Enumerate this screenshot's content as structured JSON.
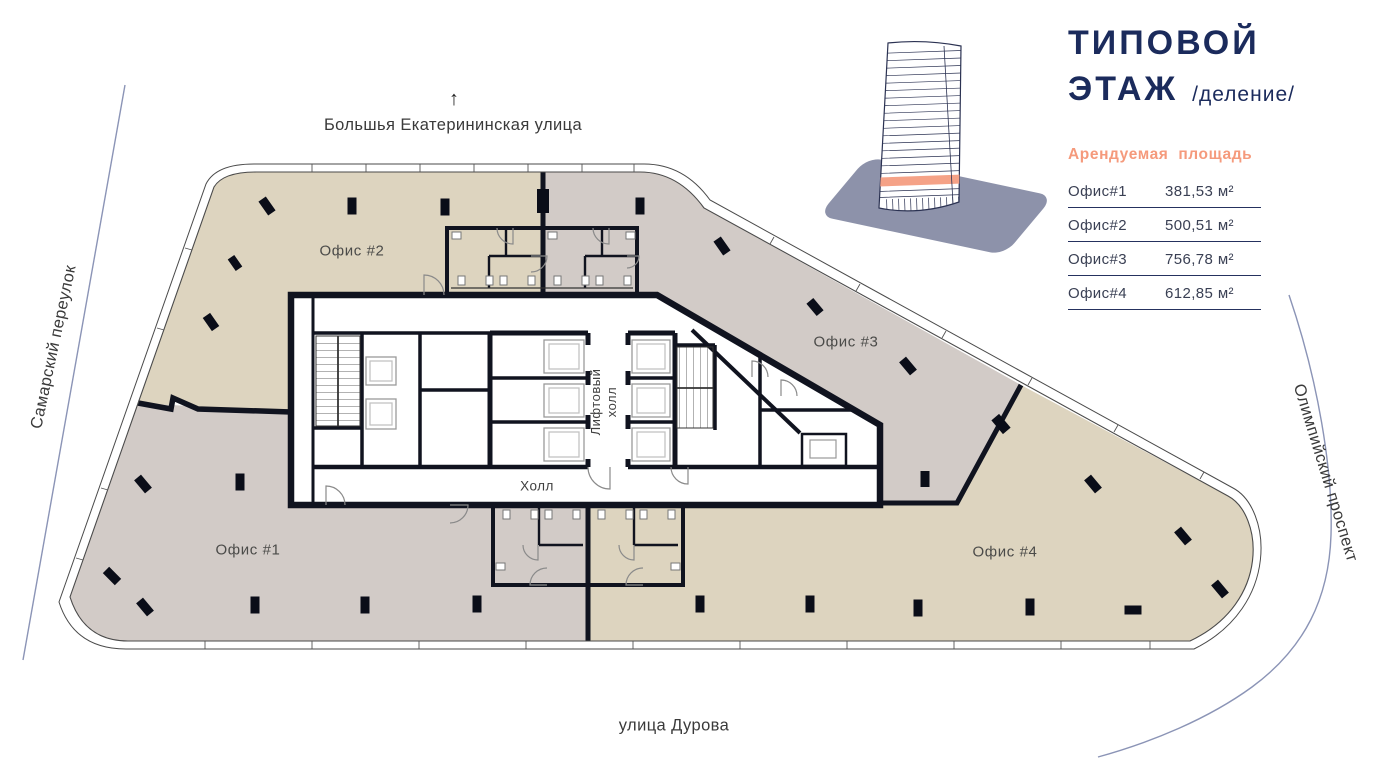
{
  "header": {
    "title_line1": "ТИПОВОЙ",
    "title_line2": "ЭТАЖ",
    "title_suffix": "/деление/",
    "building_icon": "tower-wireframe-highlighted-floor-icon"
  },
  "legend": {
    "title": "Арендуемая площадь",
    "rows": [
      {
        "name": "Офис#1",
        "area": "381,53 м²"
      },
      {
        "name": "Офис#2",
        "area": "500,51 м²"
      },
      {
        "name": "Офис#3",
        "area": "756,78 м²"
      },
      {
        "name": "Офис#4",
        "area": "612,85 м²"
      }
    ]
  },
  "streets": {
    "top_arrow": "↑",
    "top": "Большья Екатерининская улица",
    "left": "Самарский переулок",
    "right": "Олимпийский проспект",
    "bottom": "улица Дурова"
  },
  "plan": {
    "office1": "Офис #1",
    "office2": "Офис #2",
    "office3": "Офис #3",
    "office4": "Офис #4",
    "hall": "Холл",
    "lift_hall": "Лифтовый холл"
  },
  "colors": {
    "navy": "#1b2b5c",
    "orange": "#f59a7c",
    "zone_beige": "#ddd4bf",
    "zone_gray": "#d2cbc7",
    "wall": "#10131f",
    "street_line": "#8b94b6"
  }
}
